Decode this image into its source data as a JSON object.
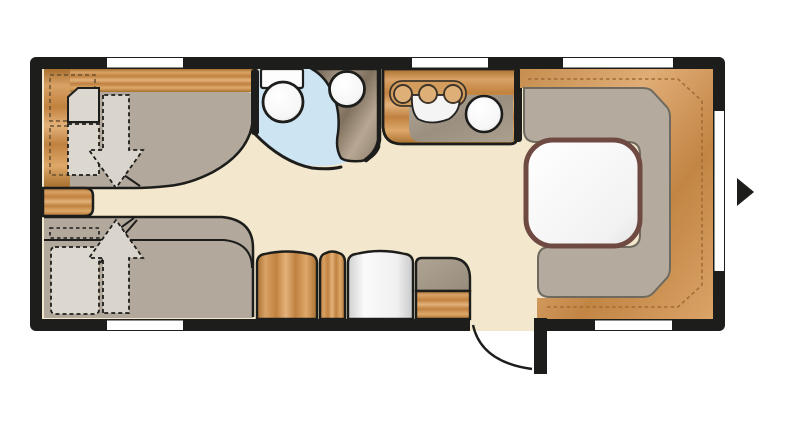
{
  "figure": {
    "kind": "caravan-floor-plan",
    "description": "Top-down floor plan of a travel trailer caravan with twin beds, bathroom, kitchen and U-shaped dinette"
  },
  "palette": {
    "wall": "#1d1d1b",
    "floor": "#f3e8cd",
    "wood": "#cd9455",
    "upholstery": "#b2a99c",
    "bedding": "#dcd8d0",
    "seat_gray": "#b4ab9e",
    "bathroom_floor": "#cde4f2",
    "worktop_gray": "#9b9080",
    "washbasin_counter": "#998a77",
    "table_border": "#6f4a43",
    "fixture_white": "#ffffff",
    "stitch_line": "#a06c36"
  },
  "inventory": {
    "bedroom": [
      "twin-single-bed-top",
      "twin-single-bed-bottom",
      "solid-pillow",
      "dashed-pillow",
      "bed-conversion-arrow-down",
      "bed-conversion-arrow-up",
      "overhead-locker-outlines",
      "bedside-drawer"
    ],
    "bathroom": [
      "toilet-with-cistern",
      "round-washbasin",
      "curved-washbasin-counter",
      "wet-room-floor"
    ],
    "kitchen": [
      "three-burner-hob",
      "round-sink",
      "wood-worktop",
      "gray-work-surface"
    ],
    "lounge": [
      "u-shaped-dinette",
      "rounded-dining-table",
      "wraparound-wood-backrest",
      "stitch-trim-line"
    ],
    "storage": [
      "wood-cabinet-wide",
      "wood-cabinet-narrow",
      "tall-white-unit",
      "entry-step-unit"
    ],
    "entry": [
      "entrance-door-leaf",
      "door-swing-arc",
      "entry-direction-arrow"
    ]
  },
  "counts": {
    "windows": 6,
    "beds": 2,
    "hob_burners": 3,
    "dinette_seat_sections": 3,
    "doors": 1
  }
}
